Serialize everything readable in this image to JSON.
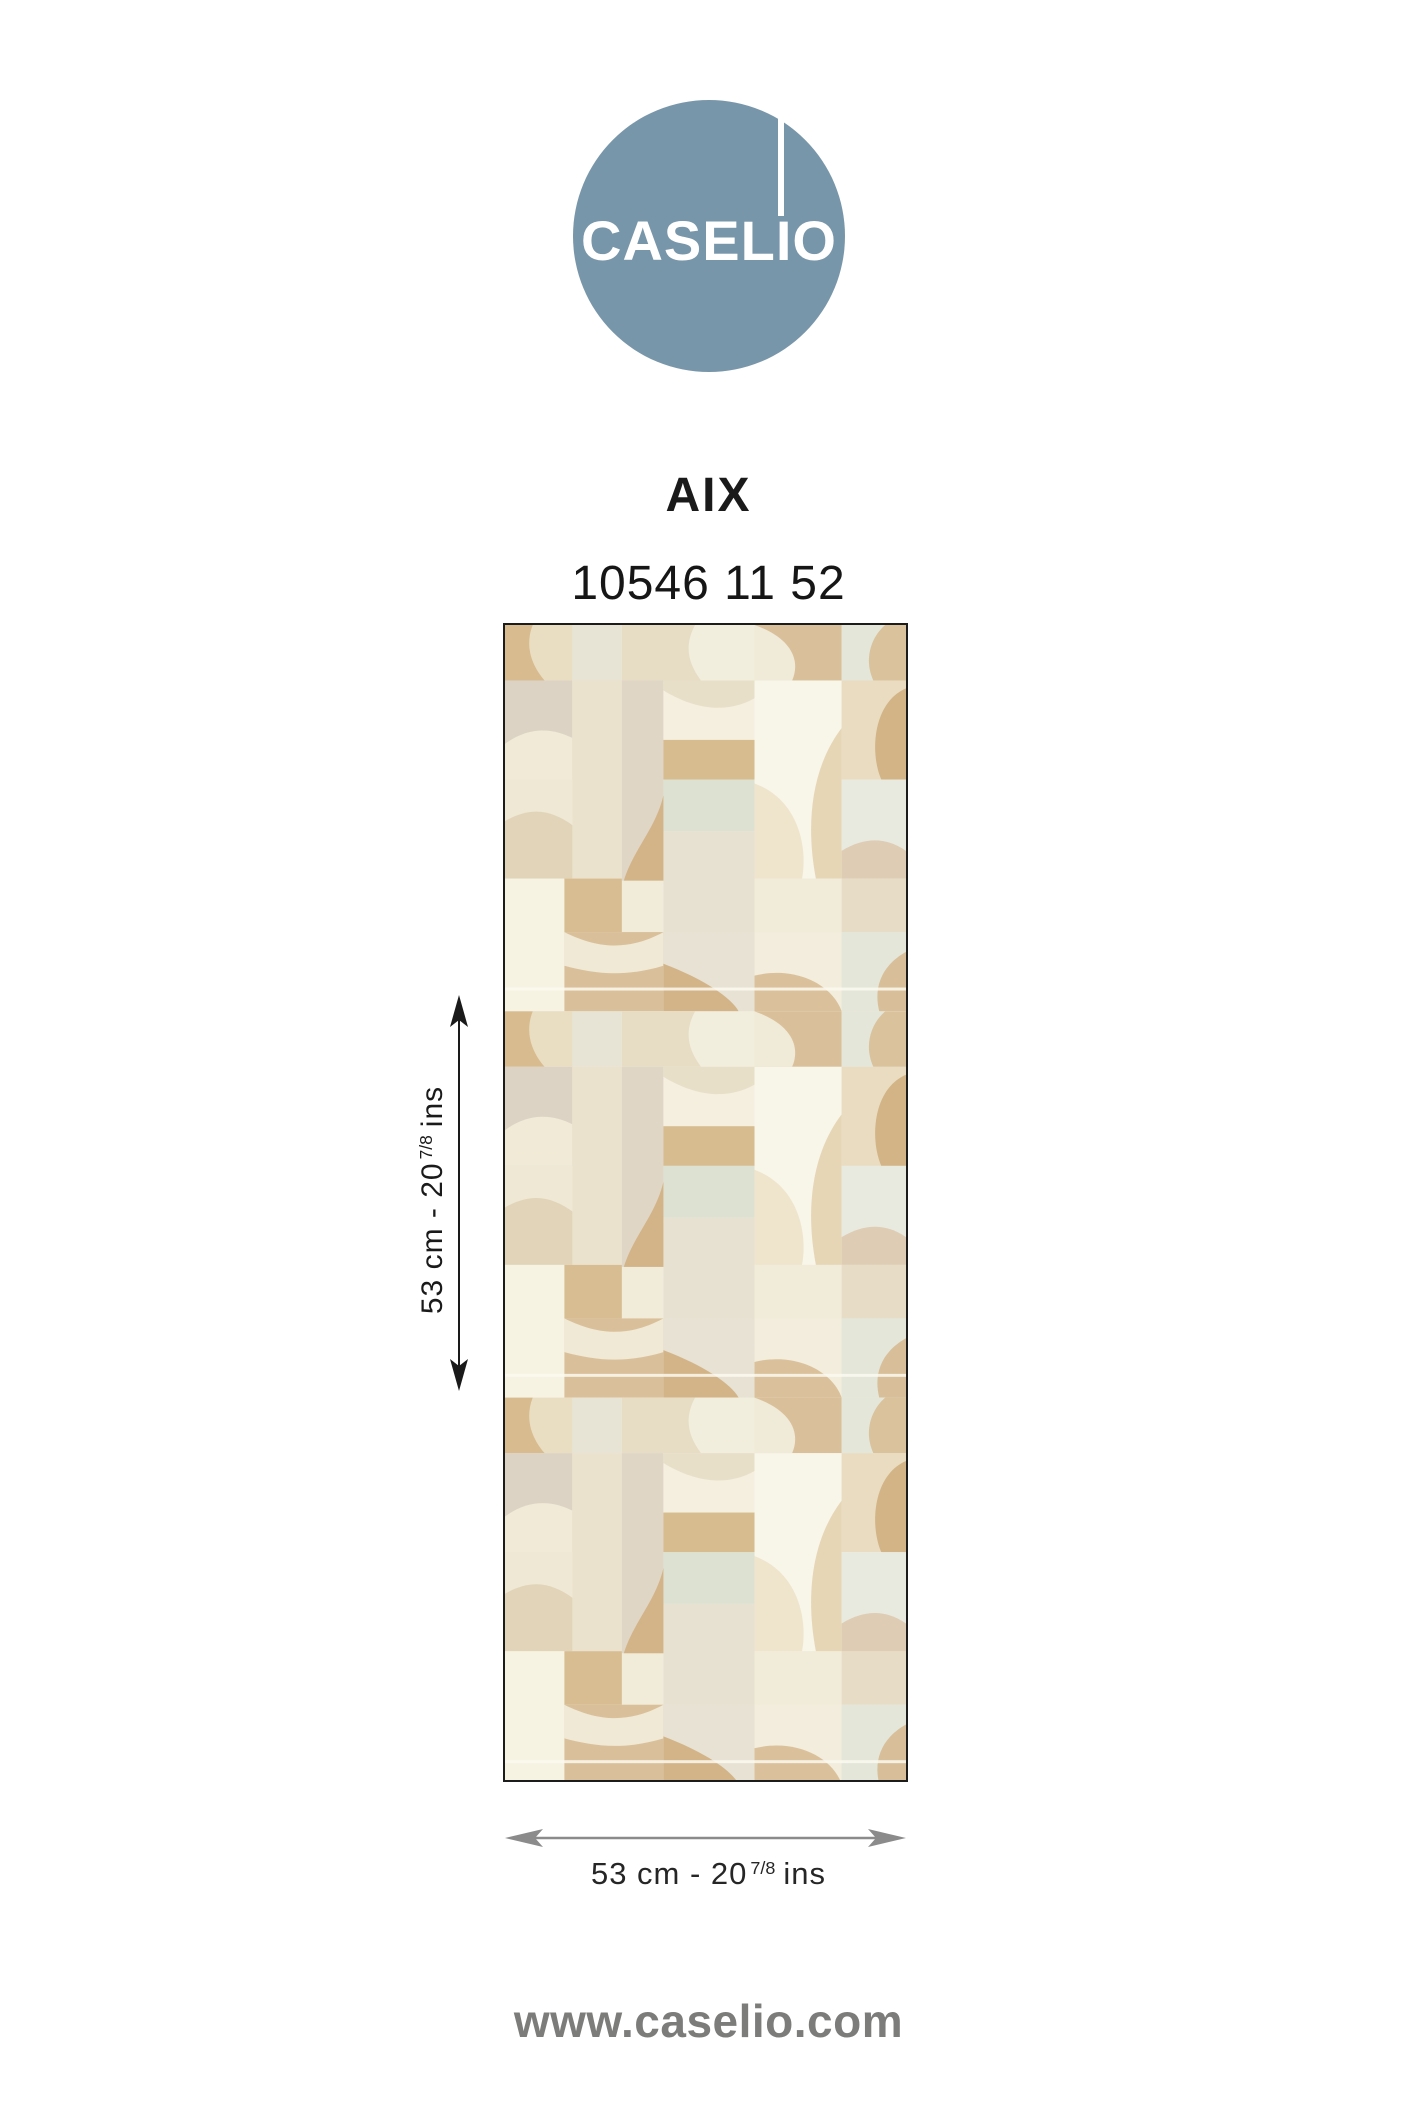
{
  "page": {
    "background": "#ffffff"
  },
  "logo": {
    "brand": "CASELIO",
    "circle_color": "#7896aa",
    "text_color": "#ffffff"
  },
  "product": {
    "collection": "AIX",
    "reference": "10546 11 52"
  },
  "swatch": {
    "description": "wallpaper-pattern-patchwork",
    "border_color": "#1c1c1c",
    "palette": [
      "#f1ecda",
      "#f8f5e9",
      "#f2eedd",
      "#e9ddc2",
      "#e7ddc5",
      "#dac09a",
      "#d8bb8f",
      "#d3b486",
      "#d7bc90",
      "#ddd3c5",
      "#e0d6c6",
      "#ebe2cd",
      "#dce1d1",
      "#e3e6d8",
      "#e8eae0",
      "#e7e1d1",
      "#f7f3e3"
    ]
  },
  "dimensions": {
    "height": {
      "prefix": "53 cm - 20",
      "fraction": "7/8",
      "unit": "ins",
      "arrow_color": "#1a1a1a"
    },
    "width": {
      "prefix": "53 cm - 20",
      "fraction": "7/8",
      "unit": "ins",
      "arrow_color": "#8b8b8b"
    }
  },
  "footer": {
    "url": "www.caselio.com",
    "color": "#7c7c7a"
  }
}
